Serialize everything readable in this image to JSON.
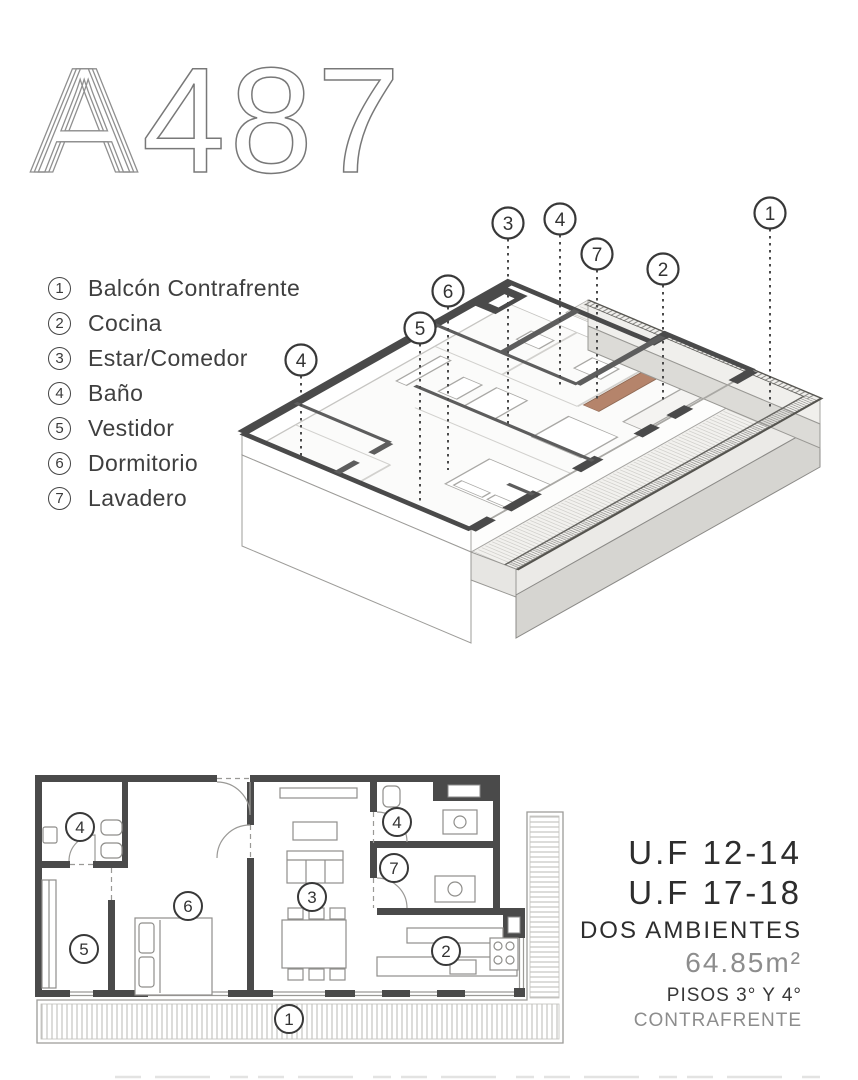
{
  "logo": {
    "letter": "A",
    "digits": "487",
    "full": "A487"
  },
  "legend": [
    {
      "num": "1",
      "label": "Balcón Contrafrente"
    },
    {
      "num": "2",
      "label": "Cocina"
    },
    {
      "num": "3",
      "label": "Estar/Comedor"
    },
    {
      "num": "4",
      "label": "Baño"
    },
    {
      "num": "5",
      "label": "Vestidor"
    },
    {
      "num": "6",
      "label": "Dormitorio"
    },
    {
      "num": "7",
      "label": "Lavadero"
    }
  ],
  "iso_callouts": [
    "6",
    "3",
    "4",
    "7",
    "2",
    "1",
    "4",
    "5"
  ],
  "plan_callouts": [
    "4",
    "6",
    "5",
    "3",
    "4",
    "7",
    "2",
    "1"
  ],
  "info": {
    "unit_line1": "U.F 12-14",
    "unit_line2": "U.F 17-18",
    "type": "DOS AMBIENTES",
    "area": "64.85m²",
    "floors": "PISOS 3° Y 4°",
    "orientation": "CONTRAFRENTE"
  },
  "colors": {
    "wall_dark": "#4a4a4a",
    "wall_mid": "#5d5d5d",
    "counter_brown": "#b5846b",
    "concrete": "#d6d5d1",
    "text_dark": "#2d2d2d",
    "text_gray": "#8d8d8d"
  }
}
